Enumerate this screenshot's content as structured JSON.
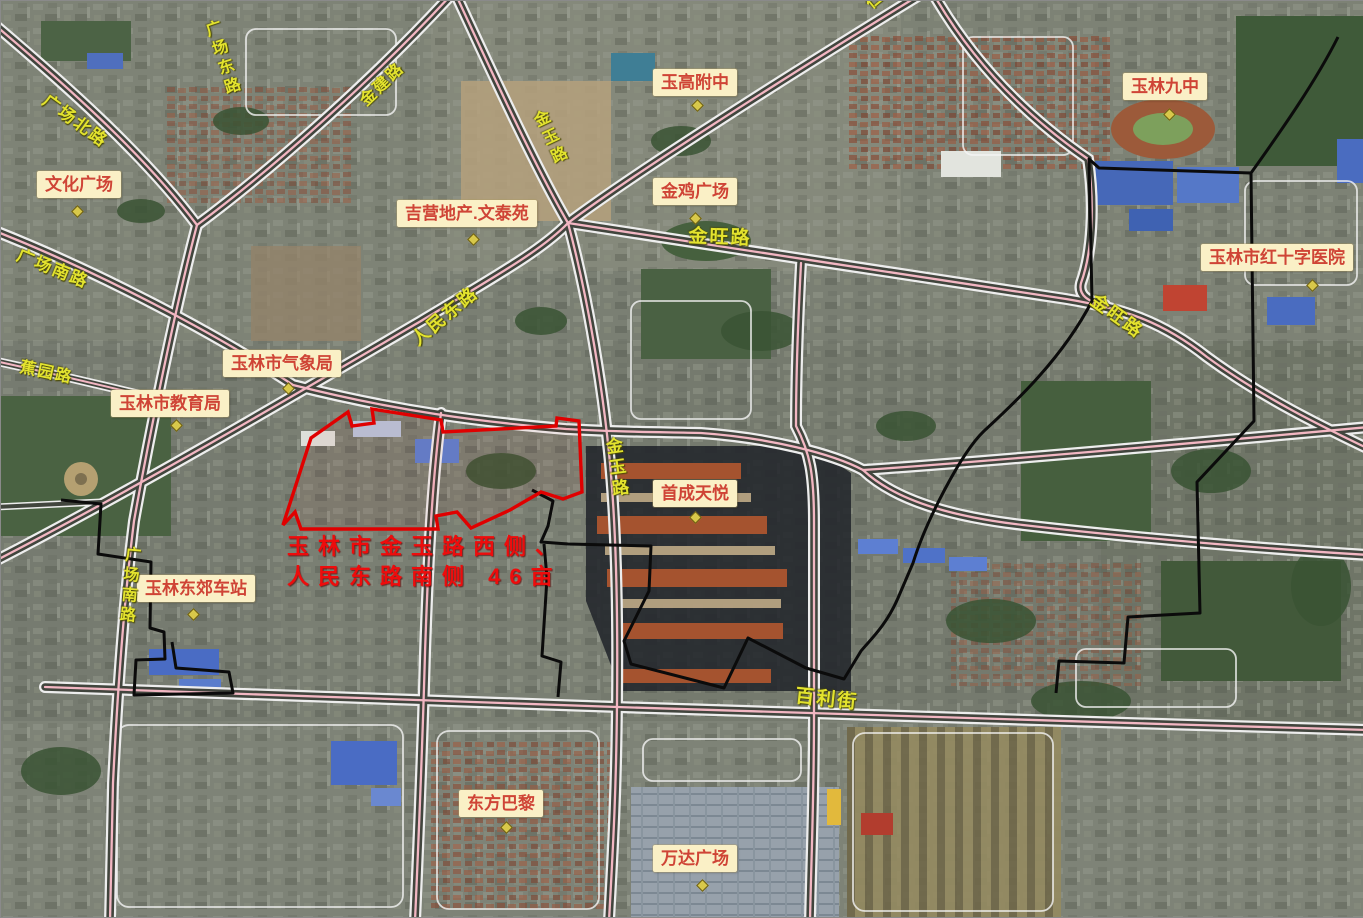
{
  "map": {
    "parcel_annotation": {
      "line1": "玉林市金玉路西侧、",
      "line2": "人民东路南侧 46亩"
    },
    "place_labels": [
      {
        "id": "wenhua-square",
        "label": "文化广场",
        "x": 36,
        "y": 170,
        "mx": 72,
        "my": 206
      },
      {
        "id": "jiying-property",
        "label": "吉营地产.文泰苑",
        "x": 396,
        "y": 199,
        "mx": 468,
        "my": 234
      },
      {
        "id": "yugao-fuzhong",
        "label": "玉高附中",
        "x": 652,
        "y": 68,
        "mx": 692,
        "my": 100
      },
      {
        "id": "jinji-square",
        "label": "金鸡广场",
        "x": 652,
        "y": 177,
        "mx": 690,
        "my": 213
      },
      {
        "id": "yulin-no9-school",
        "label": "玉林九中",
        "x": 1122,
        "y": 72,
        "mx": 1164,
        "my": 109
      },
      {
        "id": "red-cross-hospital",
        "label": "玉林市红十字医院",
        "x": 1200,
        "y": 243,
        "mx": 1307,
        "my": 280
      },
      {
        "id": "meteorological-bureau",
        "label": "玉林市气象局",
        "x": 222,
        "y": 349,
        "mx": 283,
        "my": 383
      },
      {
        "id": "education-bureau",
        "label": "玉林市教育局",
        "x": 110,
        "y": 389,
        "mx": 171,
        "my": 420
      },
      {
        "id": "shoucheng-tianyue",
        "label": "首成天悦",
        "x": 652,
        "y": 479,
        "mx": 690,
        "my": 512
      },
      {
        "id": "dongjiao-bus-station",
        "label": "玉林东郊车站",
        "x": 136,
        "y": 574,
        "mx": 188,
        "my": 609
      },
      {
        "id": "oriental-paris",
        "label": "东方巴黎",
        "x": 458,
        "y": 789,
        "mx": 501,
        "my": 822
      },
      {
        "id": "wanda-plaza",
        "label": "万达广场",
        "x": 652,
        "y": 844,
        "mx": 697,
        "my": 880
      }
    ],
    "road_labels": [
      {
        "label": "广场北路",
        "x": 52,
        "y": 86,
        "rot": 36,
        "size": 17,
        "vertical": false
      },
      {
        "label": "广场东路",
        "x": 196,
        "y": 24,
        "rot": -18,
        "size": 16,
        "vertical": true
      },
      {
        "label": "金建路",
        "x": 352,
        "y": 92,
        "rot": -44,
        "size": 16,
        "vertical": false
      },
      {
        "label": "金玉路",
        "x": 524,
        "y": 116,
        "rot": -25,
        "size": 16,
        "vertical": true
      },
      {
        "label": "人民东路",
        "x": 404,
        "y": 330,
        "rot": -40,
        "size": 18,
        "vertical": false
      },
      {
        "label": "金旺路",
        "x": 688,
        "y": 220,
        "rot": 2,
        "size": 19,
        "vertical": false
      },
      {
        "label": "金玉路",
        "x": 598,
        "y": 438,
        "rot": -8,
        "size": 17,
        "vertical": true
      },
      {
        "label": "金旺路",
        "x": 1100,
        "y": 286,
        "rot": 36,
        "size": 18,
        "vertical": false
      },
      {
        "label": "百利街",
        "x": 796,
        "y": 680,
        "rot": 6,
        "size": 19,
        "vertical": false
      },
      {
        "label": "广场南路",
        "x": 22,
        "y": 240,
        "rot": 22,
        "size": 17,
        "vertical": false
      },
      {
        "label": "广场南路",
        "x": 118,
        "y": 544,
        "rot": 5,
        "size": 16,
        "vertical": true
      },
      {
        "label": "蕉园路",
        "x": 22,
        "y": 352,
        "rot": 12,
        "size": 16,
        "vertical": false
      },
      {
        "label": "仁东路",
        "x": 858,
        "y": -6,
        "rot": -40,
        "size": 16,
        "vertical": false
      }
    ],
    "colors": {
      "parcel_outline": "#e00000",
      "district_boundary": "#0b0b0b",
      "road_centerline": "#f2b6c2",
      "road_label_text": "#e3e32e",
      "place_label_bg": "#faf0c6",
      "place_label_text": "#cf4436",
      "annotation_text": "#ee0c0c"
    }
  }
}
